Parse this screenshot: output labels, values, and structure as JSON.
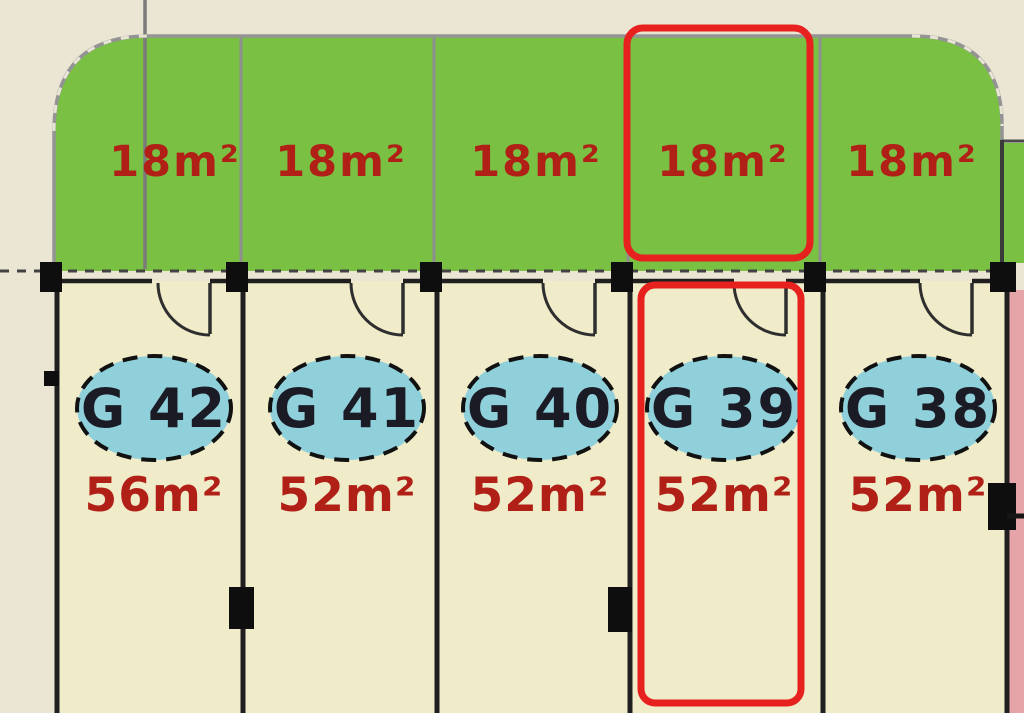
{
  "plan": {
    "type": "garage-site-plan",
    "boundary_note": "dashed site boundary line",
    "selected_unit": "G 39"
  },
  "units": [
    {
      "id": "G 42",
      "area": "56m²",
      "garden_area": "18m²",
      "highlighted": false
    },
    {
      "id": "G 41",
      "area": "52m²",
      "garden_area": "18m²",
      "highlighted": false
    },
    {
      "id": "G 40",
      "area": "52m²",
      "garden_area": "18m²",
      "highlighted": false
    },
    {
      "id": "G 39",
      "area": "52m²",
      "garden_area": "18m²",
      "highlighted": true
    },
    {
      "id": "G 38",
      "area": "52m²",
      "garden_area": "18m²",
      "highlighted": false
    }
  ],
  "colors": {
    "background_outside": "#ebe6d4",
    "unit_interior": "#f0ebc9",
    "garden_green": "#79c043",
    "boundary_gray": "#909090",
    "wall_black": "#1f1f1f",
    "area_label_red": "#b02017",
    "highlight_red": "#e7211e",
    "ellipse_blue": "#8fd0db",
    "ellipse_text": "#1b1b26",
    "neighbor_pink": "#e5a4a8"
  }
}
